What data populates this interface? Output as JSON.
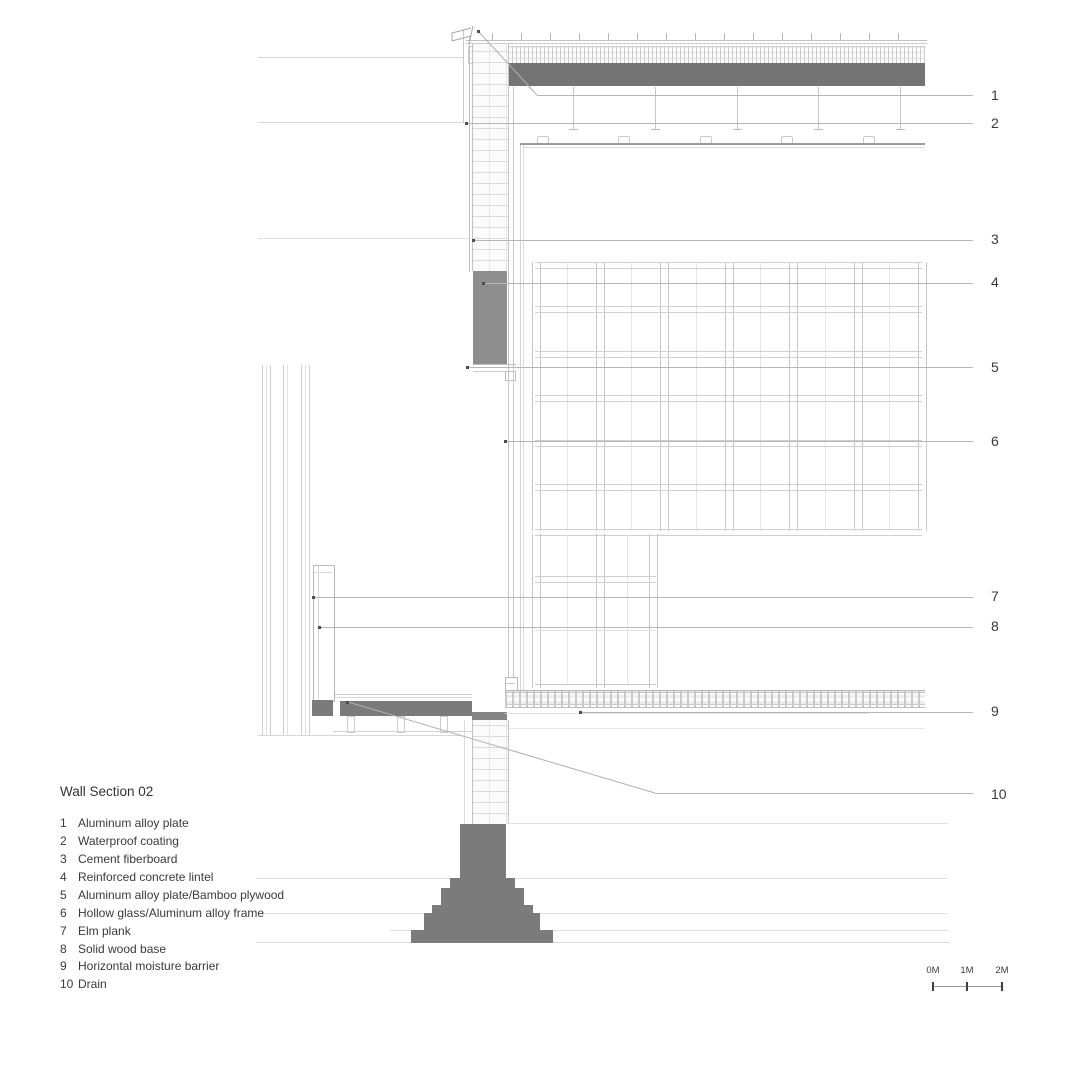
{
  "drawing": {
    "title": "Wall Section 02",
    "legend_items": [
      {
        "num": "1",
        "label": "Aluminum alloy plate"
      },
      {
        "num": "2",
        "label": "Waterproof coating"
      },
      {
        "num": "3",
        "label": "Cement fiberboard"
      },
      {
        "num": "4",
        "label": "Reinforced concrete lintel"
      },
      {
        "num": "5",
        "label": "Aluminum alloy plate/Bamboo plywood"
      },
      {
        "num": "6",
        "label": "Hollow glass/Aluminum alloy frame"
      },
      {
        "num": "7",
        "label": "Elm plank"
      },
      {
        "num": "8",
        "label": "Solid wood base"
      },
      {
        "num": "9",
        "label": "Horizontal moisture barrier"
      },
      {
        "num": "10",
        "label": "Drain"
      }
    ],
    "callouts": [
      {
        "num": "1"
      },
      {
        "num": "2"
      },
      {
        "num": "3"
      },
      {
        "num": "4"
      },
      {
        "num": "5"
      },
      {
        "num": "6"
      },
      {
        "num": "7"
      },
      {
        "num": "8"
      },
      {
        "num": "9"
      },
      {
        "num": "10"
      }
    ],
    "scale_bar": {
      "labels": [
        "0M",
        "1M",
        "2M"
      ]
    },
    "colors": {
      "concrete_fill": "#7b7b7b",
      "roof_slab_fill": "#747474",
      "lintel_fill": "#8e8e8e",
      "line_light": "#d6d6d6",
      "leader_line": "#b6b6b6",
      "text": "#3a3a3a"
    }
  }
}
